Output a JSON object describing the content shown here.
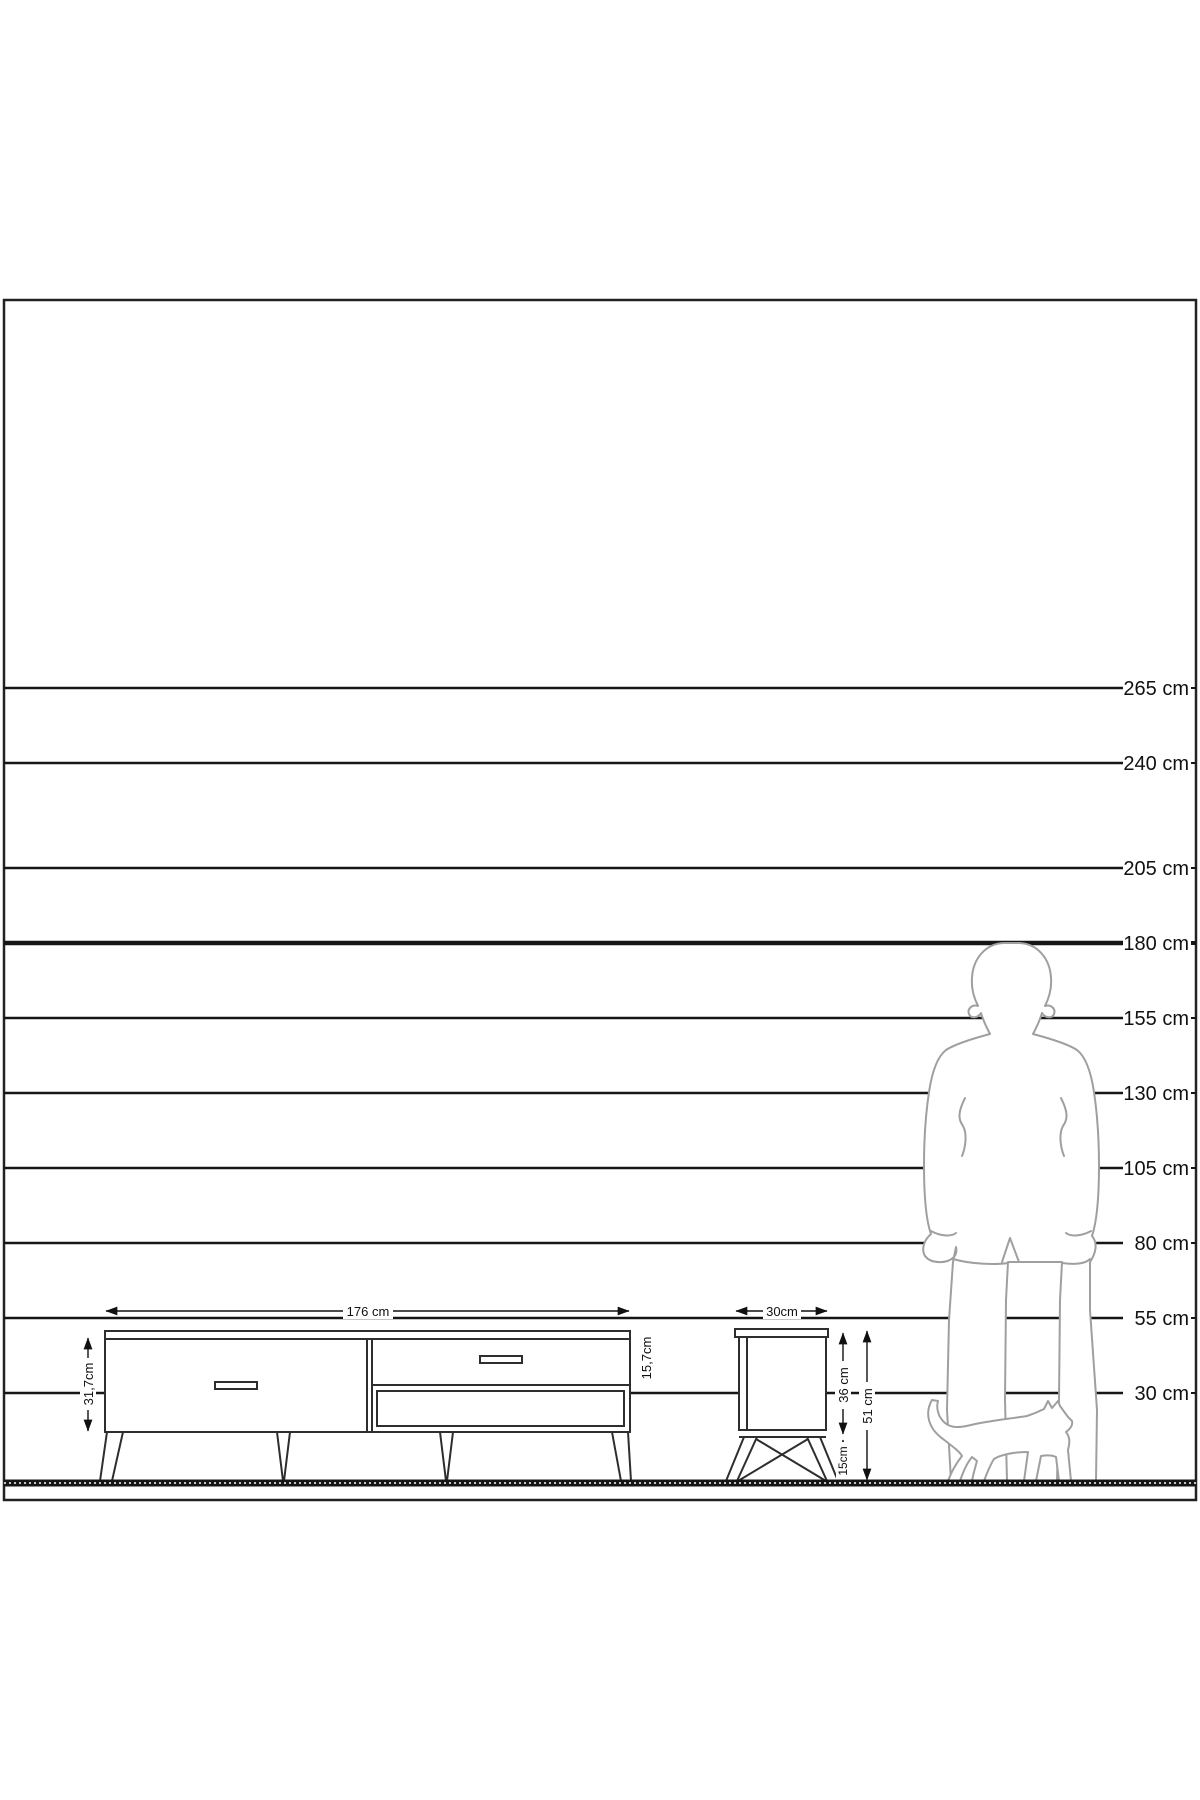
{
  "diagram": {
    "title": "furniture-size-reference-diagram",
    "unit": "cm",
    "scale": {
      "px_per_cm": 3,
      "ground_cm": 0,
      "lines": [
        {
          "label": "265 cm",
          "cm": 265,
          "bold": false
        },
        {
          "label": "240 cm",
          "cm": 240,
          "bold": false
        },
        {
          "label": "205 cm",
          "cm": 205,
          "bold": false
        },
        {
          "label": "180 cm",
          "cm": 180,
          "bold": true
        },
        {
          "label": "155 cm",
          "cm": 155,
          "bold": false
        },
        {
          "label": "130 cm",
          "cm": 130,
          "bold": false
        },
        {
          "label": "105 cm",
          "cm": 105,
          "bold": false
        },
        {
          "label": "80 cm",
          "cm": 80,
          "bold": false
        },
        {
          "label": "55 cm",
          "cm": 55,
          "bold": false
        },
        {
          "label": "30 cm",
          "cm": 30,
          "bold": false
        }
      ]
    },
    "tv_stand": {
      "width_label": "176 cm",
      "body_height_label": "31,7cm",
      "drawer_height_label": "15,7cm"
    },
    "side_table": {
      "width_label": "30cm",
      "body_height_label": "36 cm",
      "leg_height_label": "15cm",
      "total_height_label": "51 cm"
    },
    "figures": {
      "person_icon": "man-silhouette",
      "animal_icon": "cat-silhouette"
    },
    "colors": {
      "line": "#161616",
      "figure_outline": "#9f9f9f",
      "furniture_outline": "#2e2e2e"
    }
  }
}
